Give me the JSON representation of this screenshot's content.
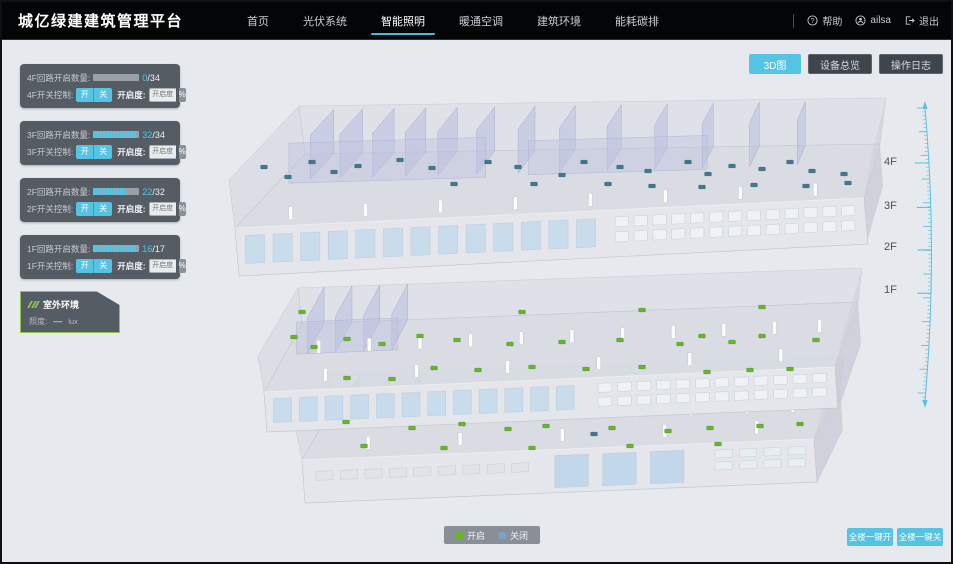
{
  "nav": {
    "brand": "城亿绿建建筑管理平台",
    "items": [
      {
        "label": "首页"
      },
      {
        "label": "光伏系统"
      },
      {
        "label": "智能照明",
        "active": true
      },
      {
        "label": "暖通空调"
      },
      {
        "label": "建筑环境"
      },
      {
        "label": "能耗碳排"
      }
    ],
    "help": "帮助",
    "user": "ailsa",
    "logout": "退出"
  },
  "view_buttons": [
    {
      "label": "3D图",
      "active": true
    },
    {
      "label": "设备总览"
    },
    {
      "label": "操作日志"
    }
  ],
  "floor_panels": [
    {
      "floor": "4F",
      "circuit_label": "4F回路开启数量:",
      "current": "0",
      "total_suffix": "/34",
      "progress_style": "width:0%",
      "switch_label": "4F开关控制:",
      "on_label": "开",
      "off_label": "关",
      "openness_label": "开启度:",
      "openness_placeholder": "开启度",
      "percent": "%"
    },
    {
      "floor": "3F",
      "circuit_label": "3F回路开启数量:",
      "current": "32",
      "total_suffix": "/34",
      "progress_style": "width:94%",
      "switch_label": "3F开关控制:",
      "on_label": "开",
      "off_label": "关",
      "openness_label": "开启度:",
      "openness_placeholder": "开启度",
      "percent": "%"
    },
    {
      "floor": "2F",
      "circuit_label": "2F回路开启数量:",
      "current": "22",
      "total_suffix": "/32",
      "progress_style": "width:69%",
      "switch_label": "2F开关控制:",
      "on_label": "开",
      "off_label": "关",
      "openness_label": "开启度:",
      "openness_placeholder": "开启度",
      "percent": "%"
    },
    {
      "floor": "1F",
      "circuit_label": "1F回路开启数量:",
      "current": "16",
      "total_suffix": "/17",
      "progress_style": "width:94%",
      "switch_label": "1F开关控制:",
      "on_label": "开",
      "off_label": "关",
      "openness_label": "开启度:",
      "openness_placeholder": "开启度",
      "percent": "%"
    }
  ],
  "outdoor": {
    "title": "室外环境",
    "illuminance_label": "照度:",
    "value": "—",
    "unit": "lux"
  },
  "floor_scale": [
    "4F",
    "3F",
    "2F",
    "1F"
  ],
  "legend": {
    "on": "开启",
    "off": "关闭",
    "on_color": "#6ab42d",
    "off_color": "#7aa3cc",
    "on_swatch": "background:#6ab42d",
    "off_swatch": "background:#7aa3cc"
  },
  "bottom_actions": [
    {
      "label": "全楼一键开"
    },
    {
      "label": "全楼一键关"
    }
  ],
  "colors": {
    "accent_cyan": "#55c3e2",
    "progress_cyan": "#4fc8e8",
    "light_on_green": "#68b42d",
    "light_off_blue": "#43798f"
  },
  "building": {
    "light_groups": [
      {
        "floor": "4F",
        "status": "closed",
        "color": "#43798f",
        "points": [
          [
            262,
            165
          ],
          [
            286,
            175
          ],
          [
            310,
            160
          ],
          [
            332,
            170
          ],
          [
            356,
            164
          ],
          [
            398,
            158
          ],
          [
            430,
            166
          ],
          [
            452,
            182
          ],
          [
            486,
            160
          ],
          [
            516,
            165
          ],
          [
            532,
            182
          ],
          [
            560,
            173
          ],
          [
            582,
            160
          ],
          [
            618,
            165
          ],
          [
            646,
            169
          ],
          [
            686,
            160
          ],
          [
            706,
            172
          ],
          [
            730,
            164
          ],
          [
            760,
            167
          ],
          [
            788,
            160
          ],
          [
            810,
            169
          ],
          [
            842,
            172
          ],
          [
            606,
            182
          ],
          [
            650,
            184
          ],
          [
            700,
            185
          ],
          [
            752,
            183
          ],
          [
            804,
            184
          ],
          [
            846,
            181
          ]
        ]
      },
      {
        "floor": "3F-2F",
        "status": "open",
        "color": "#68b42d",
        "points": [
          [
            292,
            335
          ],
          [
            312,
            345
          ],
          [
            345,
            337
          ],
          [
            380,
            342
          ],
          [
            418,
            334
          ],
          [
            432,
            366
          ],
          [
            455,
            338
          ],
          [
            476,
            368
          ],
          [
            508,
            342
          ],
          [
            530,
            365
          ],
          [
            560,
            340
          ],
          [
            584,
            367
          ],
          [
            618,
            338
          ],
          [
            640,
            365
          ],
          [
            678,
            342
          ],
          [
            700,
            334
          ],
          [
            730,
            340
          ],
          [
            760,
            334
          ],
          [
            788,
            367
          ],
          [
            814,
            338
          ],
          [
            345,
            376
          ],
          [
            390,
            377
          ],
          [
            705,
            370
          ],
          [
            748,
            368
          ],
          [
            300,
            310
          ],
          [
            520,
            310
          ],
          [
            640,
            308
          ],
          [
            760,
            305
          ]
        ]
      },
      {
        "floor": "1F",
        "status": "open",
        "color": "#68b42d",
        "points": [
          [
            344,
            420
          ],
          [
            410,
            426
          ],
          [
            460,
            422
          ],
          [
            506,
            427
          ],
          [
            544,
            424
          ],
          [
            610,
            426
          ],
          [
            666,
            429
          ],
          [
            708,
            426
          ],
          [
            758,
            424
          ],
          [
            798,
            422
          ],
          [
            362,
            444
          ],
          [
            442,
            446
          ],
          [
            530,
            446
          ],
          [
            628,
            444
          ],
          [
            716,
            442
          ]
        ]
      },
      {
        "floor": "1F",
        "status": "closed",
        "color": "#43798f",
        "points": [
          [
            592,
            432
          ]
        ]
      }
    ]
  }
}
